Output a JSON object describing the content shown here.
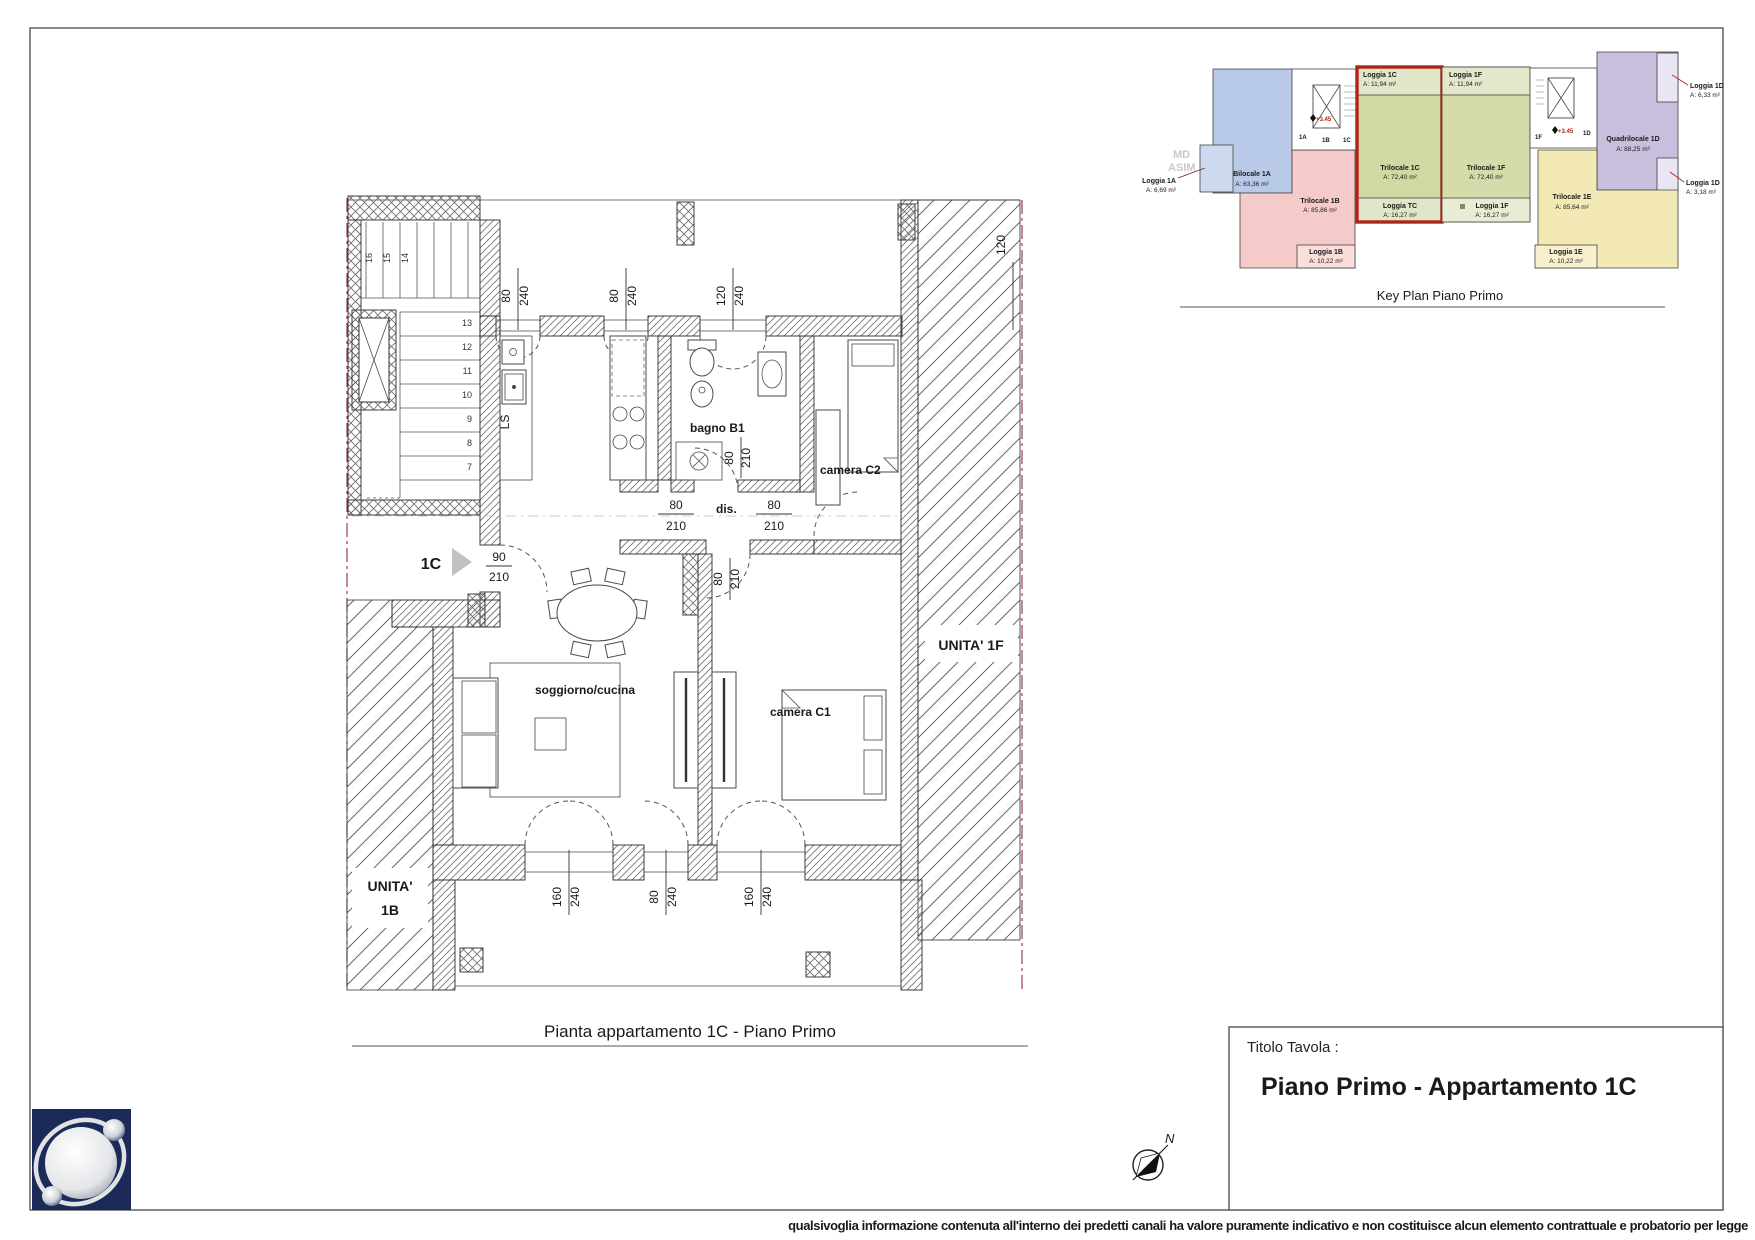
{
  "sheet": {
    "footer_disclaimer": "qualsivoglia informazione contenuta all'interno dei predetti canali ha valore puramente indicativo e non costituisce alcun elemento contrattuale e probatorio per legge"
  },
  "title_block": {
    "label": "Titolo Tavola :",
    "title": "Piano Primo - Appartamento 1C"
  },
  "compass": {
    "north": "N"
  },
  "main_plan": {
    "caption": "Pianta appartamento 1C - Piano Primo",
    "entrance_label": "1C",
    "rooms": {
      "bagno": "bagno B1",
      "camera_c2": "camera C2",
      "camera_c1": "camera C1",
      "soggiorno": "soggiorno/cucina",
      "corridor": "dis.",
      "kitchen_sink": "LS"
    },
    "adjacent_units": {
      "right": "UNITA' 1F",
      "left_1": "UNITA'",
      "left_2": "1B"
    },
    "dims": {
      "entrance": {
        "w": "90",
        "h": "210"
      },
      "top_1": {
        "w": "80",
        "h": "240"
      },
      "top_2": {
        "w": "80",
        "h": "240"
      },
      "top_3": {
        "w": "120",
        "h": "240"
      },
      "right_top": "120",
      "door_1": {
        "w": "80",
        "h": "210"
      },
      "door_2": {
        "w": "80",
        "h": "210"
      },
      "door_3": {
        "w": "80",
        "h": "210"
      },
      "door_4": {
        "w": "80",
        "h": "210"
      },
      "bottom_1": {
        "w": "160",
        "h": "240"
      },
      "bottom_2": {
        "w": "80",
        "h": "240"
      },
      "bottom_3": {
        "w": "160",
        "h": "240"
      }
    },
    "stair_numbers": {
      "n7": "7",
      "n8": "8",
      "n9": "9",
      "n10": "10",
      "n11": "11",
      "n12": "12",
      "n13": "13",
      "n14": "14",
      "n15": "15",
      "n16": "16"
    }
  },
  "key_plan": {
    "caption": "Key Plan Piano Primo",
    "level_mark": "+3.45",
    "watermark_1": "MD",
    "watermark_2": "ASIM",
    "cores": {
      "c1a": "1A",
      "c1b": "1B",
      "c1c": "1C",
      "c1f": "1F",
      "c1d": "1D"
    },
    "units": {
      "u1a": {
        "name": "Bilocale 1A",
        "area": "A: 63,36 m²"
      },
      "u1b": {
        "name": "Trilocale 1B",
        "area": "A: 85,86 m²"
      },
      "u1c": {
        "name": "Trilocale 1C",
        "area": "A: 72,40 m²"
      },
      "u1f": {
        "name": "Trilocale 1F",
        "area": "A: 72,40 m²"
      },
      "u1d": {
        "name": "Quadrilocale 1D",
        "area": "A: 88,25 m²"
      },
      "u1e": {
        "name": "Trilocale 1E",
        "area": "A: 85,64 m²"
      }
    },
    "loggias": {
      "l1a": {
        "name": "Loggia 1A",
        "area": "A: 6,69 m²"
      },
      "l1b": {
        "name": "Loggia 1B",
        "area": "A: 10,22 m²"
      },
      "l1c": {
        "name": "Loggia 1C",
        "area": "A: 11,94 m²"
      },
      "ltc": {
        "name": "Loggia TC",
        "area": "A: 16,27 m²"
      },
      "l1f_top": {
        "name": "Loggia 1F",
        "area": "A: 11,94 m²"
      },
      "l1f_bot": {
        "name": "Loggia 1F",
        "area": "A: 16,27 m²"
      },
      "l1d_top": {
        "name": "Loggia 1D",
        "area": "A: 6,33 m²"
      },
      "l1d_side": {
        "name": "Loggia 1D",
        "area": "A: 3,18 m²"
      },
      "l1e": {
        "name": "Loggia 1E",
        "area": "A: 10,22 m²"
      }
    }
  },
  "colors": {
    "highlight_red": "#b02418",
    "boundary_red": "#8e2f35",
    "logo_navy": "#1c2a5a",
    "unit_blue": "#b9c9e8",
    "unit_pink": "#f4cbc8",
    "unit_green": "#cfd9a2",
    "unit_purple": "#c9bedd",
    "unit_yellow": "#f2e9b4"
  }
}
